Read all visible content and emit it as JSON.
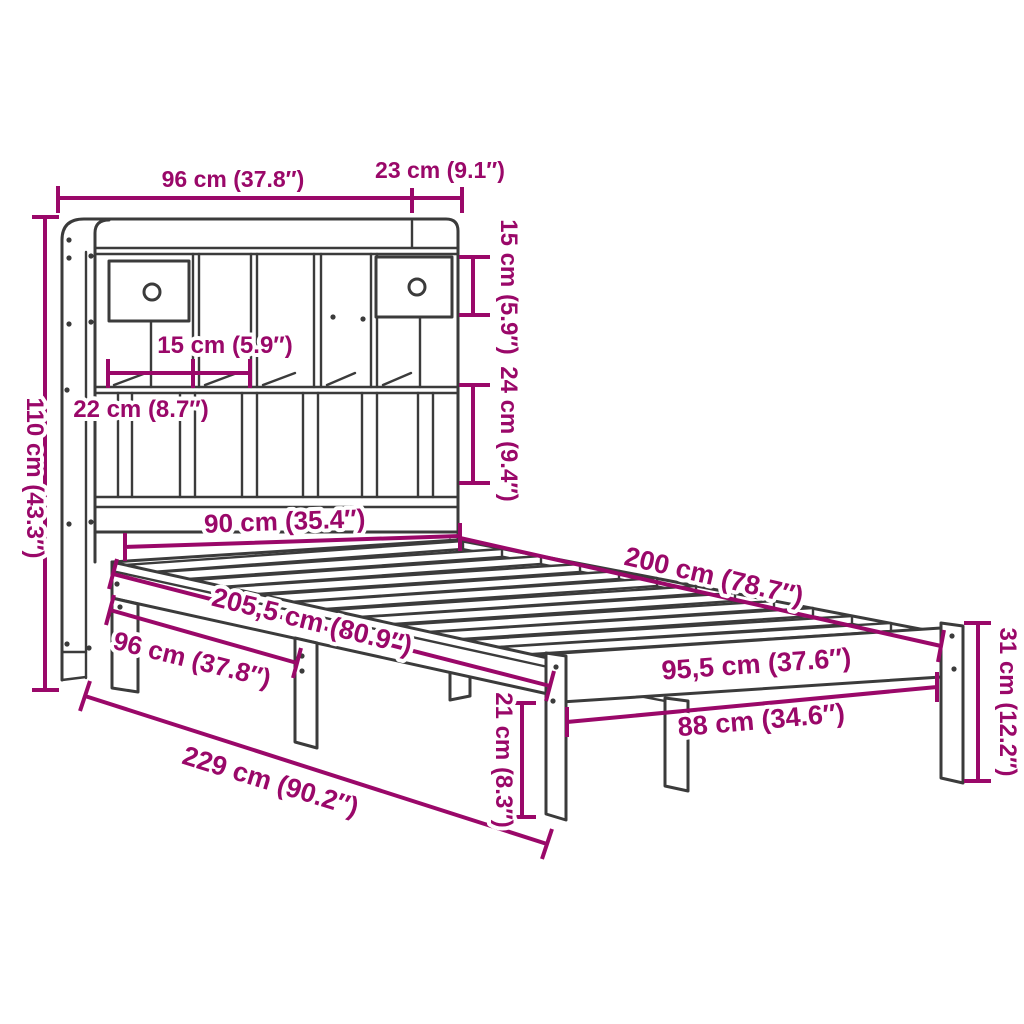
{
  "figure": {
    "subject": "Bookcase bed frame with storage headboard — product dimension diagram",
    "style": "technical line drawing with magenta dimension annotations",
    "accent_color": "#9A0869",
    "line_color": "#3B3B3B",
    "background_color": "#FFFFFF",
    "slat_count": 13
  },
  "labels": {
    "headboard_width": "96 cm (37.8″)",
    "headboard_depth_top": "23 cm (9.1″)",
    "top_shelf_height": "15 cm (5.9″)",
    "lower_shelf_height": "24 cm (9.4″)",
    "headboard_height": "110 cm (43.3″)",
    "cubby_width_small": "15 cm (5.9″)",
    "cubby_width_large": "22 cm (8.7″)",
    "bed_inner_width": "90 cm (35.4″)",
    "bed_inner_length": "200 cm (78.7″)",
    "total_length": "205,5 cm (80.9″)",
    "bookcase_section_length": "96 cm (37.8″)",
    "foot_end_width": "95,5 cm (37.6″)",
    "foot_inner_width": "88 cm (34.6″)",
    "under_bed_clearance": "21 cm (8.3″)",
    "foot_end_height": "31 cm (12.2″)",
    "total_footprint_length": "229 cm (90.2″)"
  }
}
